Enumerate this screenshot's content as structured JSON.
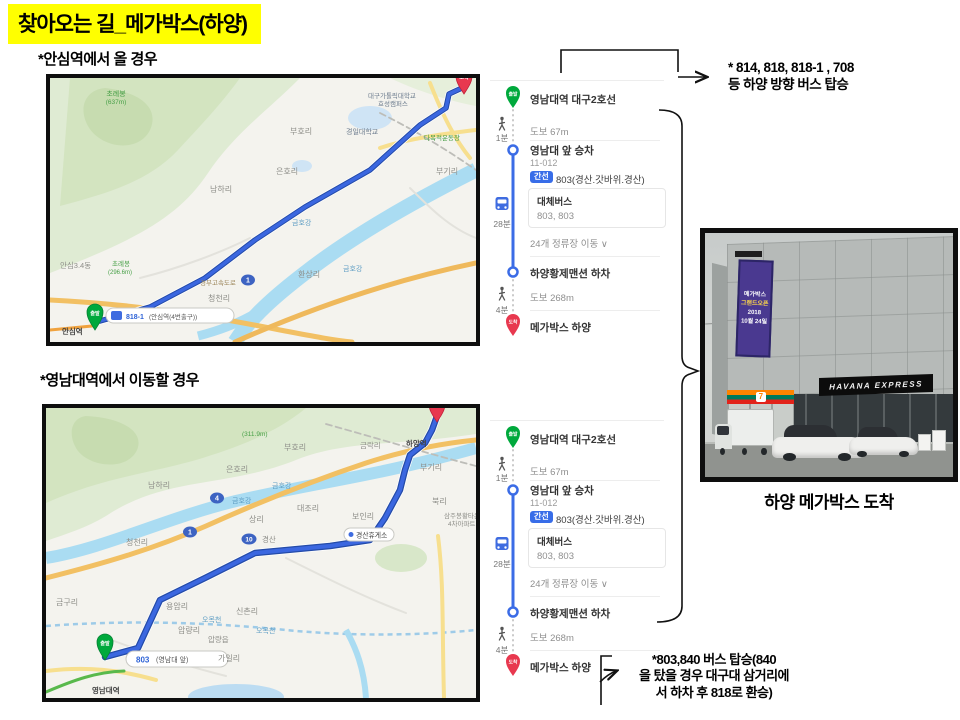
{
  "slide": {
    "title": "찾아오는 길_메가박스(하양)",
    "section1_label": "*안심역에서 올 경우",
    "section2_label": "*영남대역에서 이동할 경우",
    "photo_caption": "하양 메가박스 도착"
  },
  "annotations": {
    "bus_note_line1": "* 814, 818, 818-1 , 708",
    "bus_note_line2": "등 하양 방향 버스 탑승",
    "transfer_note_line1": "*803,840 버스 탑승(840",
    "transfer_note_line2": "을 탔을 경우 대구대 삼거리에",
    "transfer_note_line3": "서 하차 후 818로 환승)"
  },
  "route_panel": {
    "start_badge": "출발",
    "start_station": "영남대역 대구2호선",
    "walk1_time": "1분",
    "walk1": "도보 67m",
    "board_stop": "영남대 앞 승차",
    "board_stop_id": "11-012",
    "bus_badge": "간선",
    "bus_line": "803(경산.갓바위.경산)",
    "alt_bus_title": "대체버스",
    "alt_bus": "803, 803",
    "ride_time": "28분",
    "stops_info": "24개 정류장 이동 ∨",
    "alight_stop": "하양황제맨션 하차",
    "walk2_time": "4분",
    "walk2": "도보 268m",
    "end_badge": "도착",
    "destination": "메가박스 하양"
  },
  "map1": {
    "route_points": "50,243 100,229 155,200 205,162 255,129 320,92 370,47 396,30 399,16 412,10",
    "start_label": "출발",
    "end_label": "도착",
    "bus_stop_badge": "818-1",
    "bus_stop_name": "(안심역(4번출구))",
    "shield1": "1",
    "labels": [
      {
        "t": "초례봉",
        "x": 66,
        "y": 18,
        "c": "#48a048",
        "s": 7,
        "a": "middle"
      },
      {
        "t": "(637m)",
        "x": 66,
        "y": 26,
        "c": "#48a048",
        "s": 6.5,
        "a": "middle"
      },
      {
        "t": "남하리",
        "x": 160,
        "y": 114,
        "c": "#8d8d88",
        "s": 8
      },
      {
        "t": "은호리",
        "x": 226,
        "y": 96,
        "c": "#8d8d88",
        "s": 8
      },
      {
        "t": "부호리",
        "x": 240,
        "y": 56,
        "c": "#8d8d88",
        "s": 8
      },
      {
        "t": "경일대학교",
        "x": 296,
        "y": 56,
        "c": "#6b7b8d",
        "s": 7
      },
      {
        "t": "대구가톨릭대학교",
        "x": 318,
        "y": 20,
        "c": "#6b7b8d",
        "s": 6.5
      },
      {
        "t": "효성캠퍼스",
        "x": 328,
        "y": 28,
        "c": "#6b7b8d",
        "s": 6.5
      },
      {
        "t": "금호강",
        "x": 242,
        "y": 147,
        "c": "#5f9ec4",
        "s": 7
      },
      {
        "t": "금호강",
        "x": 293,
        "y": 193,
        "c": "#5f9ec4",
        "s": 7
      },
      {
        "t": "부기리",
        "x": 386,
        "y": 96,
        "c": "#8d8d88",
        "s": 8
      },
      {
        "t": "다목적운동장",
        "x": 374,
        "y": 62,
        "c": "#3f9b3f",
        "s": 6.5
      },
      {
        "t": "환상리",
        "x": 248,
        "y": 199,
        "c": "#8d8d88",
        "s": 8
      },
      {
        "t": "청천리",
        "x": 158,
        "y": 223,
        "c": "#8d8d88",
        "s": 8
      },
      {
        "t": "안심3.4동",
        "x": 10,
        "y": 190,
        "c": "#8d8d88",
        "s": 7.5
      },
      {
        "t": "초례봉",
        "x": 62,
        "y": 188,
        "c": "#48a048",
        "s": 6.5
      },
      {
        "t": "(296.6m)",
        "x": 58,
        "y": 196,
        "c": "#48a048",
        "s": 6
      },
      {
        "t": "경부고속도로",
        "x": 150,
        "y": 207,
        "c": "#9b8558",
        "s": 6.5
      },
      {
        "t": "안심역",
        "x": 12,
        "y": 256,
        "c": "#444444",
        "s": 7.5,
        "w": "bold"
      }
    ]
  },
  "map2": {
    "route_points": "59,249 92,240 114,192 159,170 209,145 284,138 324,132 339,110 354,82 359,62 364,47 379,35 386,22 391,8",
    "start_label": "출발",
    "end_label": "도착",
    "bubble_num": "803",
    "bubble_name": "(영남대 앞)",
    "shield_4": "4",
    "shield_1": "1",
    "shield_10": "10",
    "rest_stop": "경산휴게소",
    "labels": [
      {
        "t": "(311.9m)",
        "x": 196,
        "y": 28,
        "c": "#48a048",
        "s": 6.5
      },
      {
        "t": "남하리",
        "x": 102,
        "y": 80,
        "c": "#8d8d88",
        "s": 8
      },
      {
        "t": "은호리",
        "x": 180,
        "y": 64,
        "c": "#8d8d88",
        "s": 8
      },
      {
        "t": "부호리",
        "x": 238,
        "y": 42,
        "c": "#8d8d88",
        "s": 8
      },
      {
        "t": "금락리",
        "x": 314,
        "y": 40,
        "c": "#8d8d88",
        "s": 7.5
      },
      {
        "t": "하양역",
        "x": 360,
        "y": 38,
        "c": "#444444",
        "s": 7.5,
        "w": "bold"
      },
      {
        "t": "부기리",
        "x": 374,
        "y": 62,
        "c": "#8d8d88",
        "s": 8
      },
      {
        "t": "북리",
        "x": 386,
        "y": 96,
        "c": "#8d8d88",
        "s": 8
      },
      {
        "t": "보인리",
        "x": 306,
        "y": 111,
        "c": "#8d8d88",
        "s": 8
      },
      {
        "t": "대조리",
        "x": 251,
        "y": 103,
        "c": "#8d8d88",
        "s": 8
      },
      {
        "t": "상리",
        "x": 203,
        "y": 114,
        "c": "#8d8d88",
        "s": 8
      },
      {
        "t": "경산",
        "x": 216,
        "y": 134,
        "c": "#8d8d88",
        "s": 7.5
      },
      {
        "t": "금호강",
        "x": 186,
        "y": 95,
        "c": "#5f9ec4",
        "s": 7
      },
      {
        "t": "금호강",
        "x": 226,
        "y": 80,
        "c": "#5f9ec4",
        "s": 7
      },
      {
        "t": "청천리",
        "x": 80,
        "y": 137,
        "c": "#8d8d88",
        "s": 8
      },
      {
        "t": "금구리",
        "x": 10,
        "y": 197,
        "c": "#8d8d88",
        "s": 8
      },
      {
        "t": "용암리",
        "x": 120,
        "y": 201,
        "c": "#8d8d88",
        "s": 8
      },
      {
        "t": "신촌리",
        "x": 190,
        "y": 206,
        "c": "#8d8d88",
        "s": 8
      },
      {
        "t": "오목천",
        "x": 156,
        "y": 214,
        "c": "#5f9ec4",
        "s": 7
      },
      {
        "t": "오목천",
        "x": 210,
        "y": 225,
        "c": "#5f9ec4",
        "s": 7
      },
      {
        "t": "압량리",
        "x": 132,
        "y": 225,
        "c": "#8d8d88",
        "s": 8
      },
      {
        "t": "압량읍",
        "x": 162,
        "y": 234,
        "c": "#8d8d88",
        "s": 7.5
      },
      {
        "t": "가일리",
        "x": 172,
        "y": 253,
        "c": "#8d8d88",
        "s": 8
      },
      {
        "t": "삼주봉황타운",
        "x": 398,
        "y": 110,
        "c": "#8d8d88",
        "s": 6.5
      },
      {
        "t": "4차아파트",
        "x": 402,
        "y": 118,
        "c": "#8d8d88",
        "s": 6.5
      },
      {
        "t": "영남대역",
        "x": 46,
        "y": 285,
        "c": "#444444",
        "s": 7.5,
        "w": "bold"
      }
    ]
  },
  "photo": {
    "sign": "HAVANA EXPRESS",
    "store_logo": "7",
    "banner_lines": [
      "메가박스",
      "그랜드오픈",
      "2018",
      "10월 24일"
    ]
  },
  "colors": {
    "highlight": "#ffff00",
    "route_blue": "#3b67e0",
    "route_casing": "#244ba8",
    "naver_green": "#00a93c",
    "naver_red": "#e8384f",
    "badge_blue": "#386de8"
  }
}
